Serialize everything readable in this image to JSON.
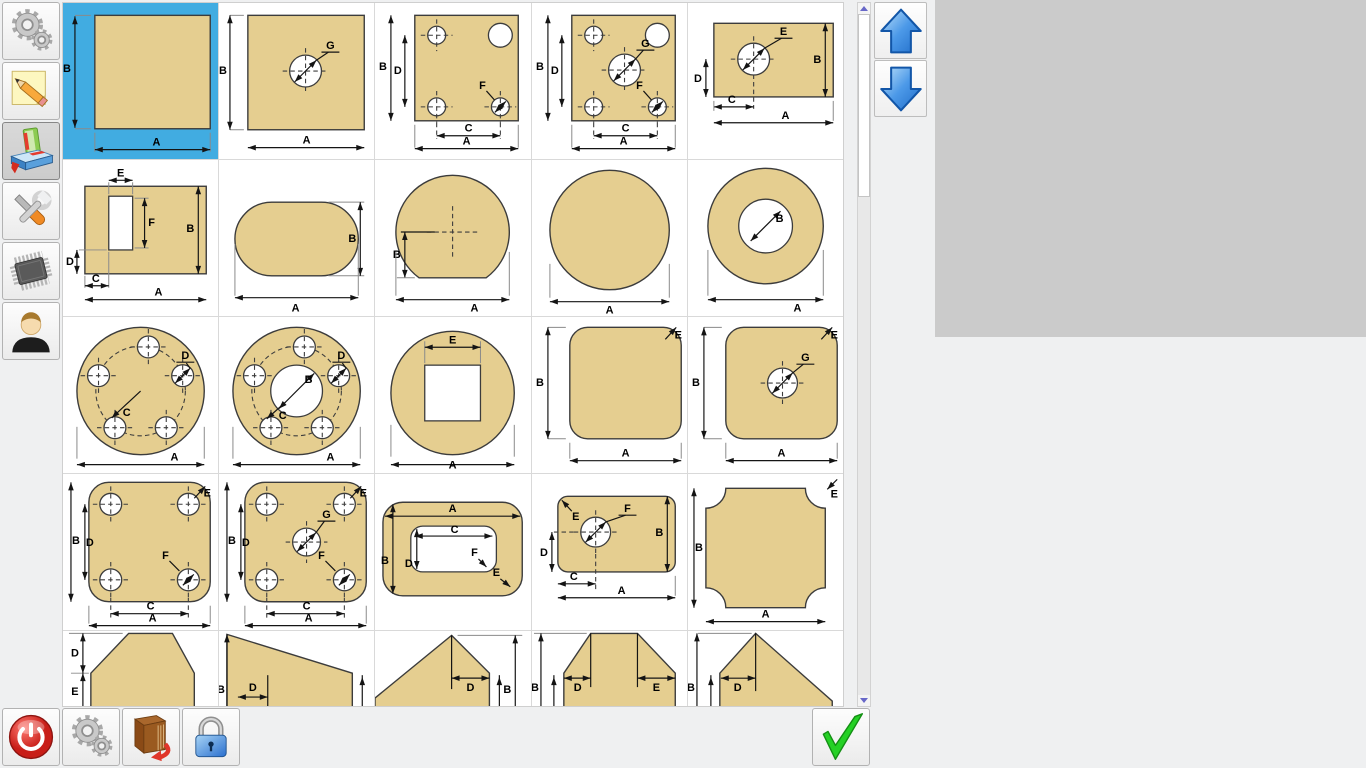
{
  "window": {
    "width": 1366,
    "height": 768,
    "bg": "#EFF0F1"
  },
  "colors": {
    "selection_blue": "#41ACE1",
    "shape_fill": "#E5CE90",
    "shape_stroke": "#3C3C3C",
    "grid_line": "#D9D9D9",
    "preview_panel_gray": "#CBCBCB",
    "nav_arrow_blue": "#2F7FD6",
    "check_green": "#2BD12B",
    "power_red": "#D92B26",
    "lock_blue": "#4E9BE0",
    "scroll_arrow_purple": "#6868C8"
  },
  "sidebar": {
    "items": [
      {
        "id": "settings",
        "icon": "gears-icon",
        "selected": false
      },
      {
        "id": "notes",
        "icon": "note-pencil-icon",
        "selected": false
      },
      {
        "id": "library",
        "icon": "books-icon",
        "selected": true
      },
      {
        "id": "tools",
        "icon": "tools-icon",
        "selected": false
      },
      {
        "id": "hardware",
        "icon": "chip-icon",
        "selected": false
      },
      {
        "id": "user",
        "icon": "user-icon",
        "selected": false
      }
    ]
  },
  "catalog": {
    "selected_index": 0,
    "cells": [
      {
        "kind": "sq",
        "labels": {
          "A": "A",
          "B": "B"
        }
      },
      {
        "kind": "sqh",
        "labels": {
          "A": "A",
          "B": "B",
          "G": "G"
        }
      },
      {
        "kind": "sq4",
        "labels": {
          "A": "A",
          "B": "B",
          "C": "C",
          "D": "D",
          "F": "F"
        }
      },
      {
        "kind": "sq4c",
        "labels": {
          "A": "A",
          "B": "B",
          "C": "C",
          "D": "D",
          "F": "F",
          "G": "G"
        }
      },
      {
        "kind": "rect1h",
        "labels": {
          "A": "A",
          "B": "B",
          "C": "C",
          "D": "D",
          "E": "E"
        }
      },
      {
        "kind": "rectslot",
        "labels": {
          "A": "A",
          "B": "B",
          "C": "C",
          "D": "D",
          "E": "E",
          "F": "F"
        }
      },
      {
        "kind": "stadium",
        "labels": {
          "A": "A",
          "B": "B"
        }
      },
      {
        "kind": "circflat",
        "labels": {
          "A": "A",
          "B": "B"
        }
      },
      {
        "kind": "circle",
        "labels": {
          "A": "A"
        }
      },
      {
        "kind": "ring",
        "labels": {
          "A": "A",
          "B": "B"
        }
      },
      {
        "kind": "circ5",
        "labels": {
          "A": "A",
          "C": "C",
          "D": "D"
        }
      },
      {
        "kind": "circ5c",
        "labels": {
          "A": "A",
          "B": "B",
          "C": "C",
          "D": "D"
        }
      },
      {
        "kind": "circsq",
        "labels": {
          "A": "A",
          "E": "E"
        }
      },
      {
        "kind": "rsq",
        "labels": {
          "A": "A",
          "B": "B",
          "E": "E"
        }
      },
      {
        "kind": "rsqh",
        "labels": {
          "A": "A",
          "B": "B",
          "E": "E",
          "G": "G"
        }
      },
      {
        "kind": "rsq4",
        "labels": {
          "A": "A",
          "B": "B",
          "C": "C",
          "D": "D",
          "E": "E",
          "F": "F"
        }
      },
      {
        "kind": "rsq4c",
        "labels": {
          "A": "A",
          "B": "B",
          "C": "C",
          "D": "D",
          "E": "E",
          "F": "F",
          "G": "G"
        }
      },
      {
        "kind": "rrecthole",
        "labels": {
          "A": "A",
          "B": "B",
          "C": "C",
          "D": "D",
          "E": "E",
          "F": "F"
        }
      },
      {
        "kind": "rectr1h",
        "labels": {
          "A": "A",
          "B": "B",
          "C": "C",
          "D": "D",
          "E": "E",
          "F": "F"
        }
      },
      {
        "kind": "sqconcave",
        "labels": {
          "A": "A",
          "B": "B",
          "E": "E"
        }
      },
      {
        "kind": "house",
        "labels": {
          "D": "D",
          "E": "E"
        }
      },
      {
        "kind": "rtrap",
        "labels": {
          "B": "B",
          "D": "D"
        }
      },
      {
        "kind": "peak",
        "labels": {
          "B": "B",
          "D": "D"
        }
      },
      {
        "kind": "trapflat",
        "labels": {
          "B": "B",
          "D": "D",
          "E": "E"
        }
      },
      {
        "kind": "asym",
        "labels": {
          "B": "B",
          "D": "D"
        }
      }
    ]
  },
  "nav": {
    "buttons": [
      {
        "id": "page-up",
        "icon": "arrow-up-icon"
      },
      {
        "id": "page-down",
        "icon": "arrow-down-icon"
      }
    ]
  },
  "toolbar": {
    "buttons": [
      {
        "id": "power",
        "icon": "power-icon"
      },
      {
        "id": "settings",
        "icon": "gears-icon"
      },
      {
        "id": "log",
        "icon": "book-arrow-icon"
      },
      {
        "id": "lock",
        "icon": "lock-icon"
      }
    ],
    "confirm": {
      "id": "confirm",
      "icon": "check-icon"
    }
  }
}
